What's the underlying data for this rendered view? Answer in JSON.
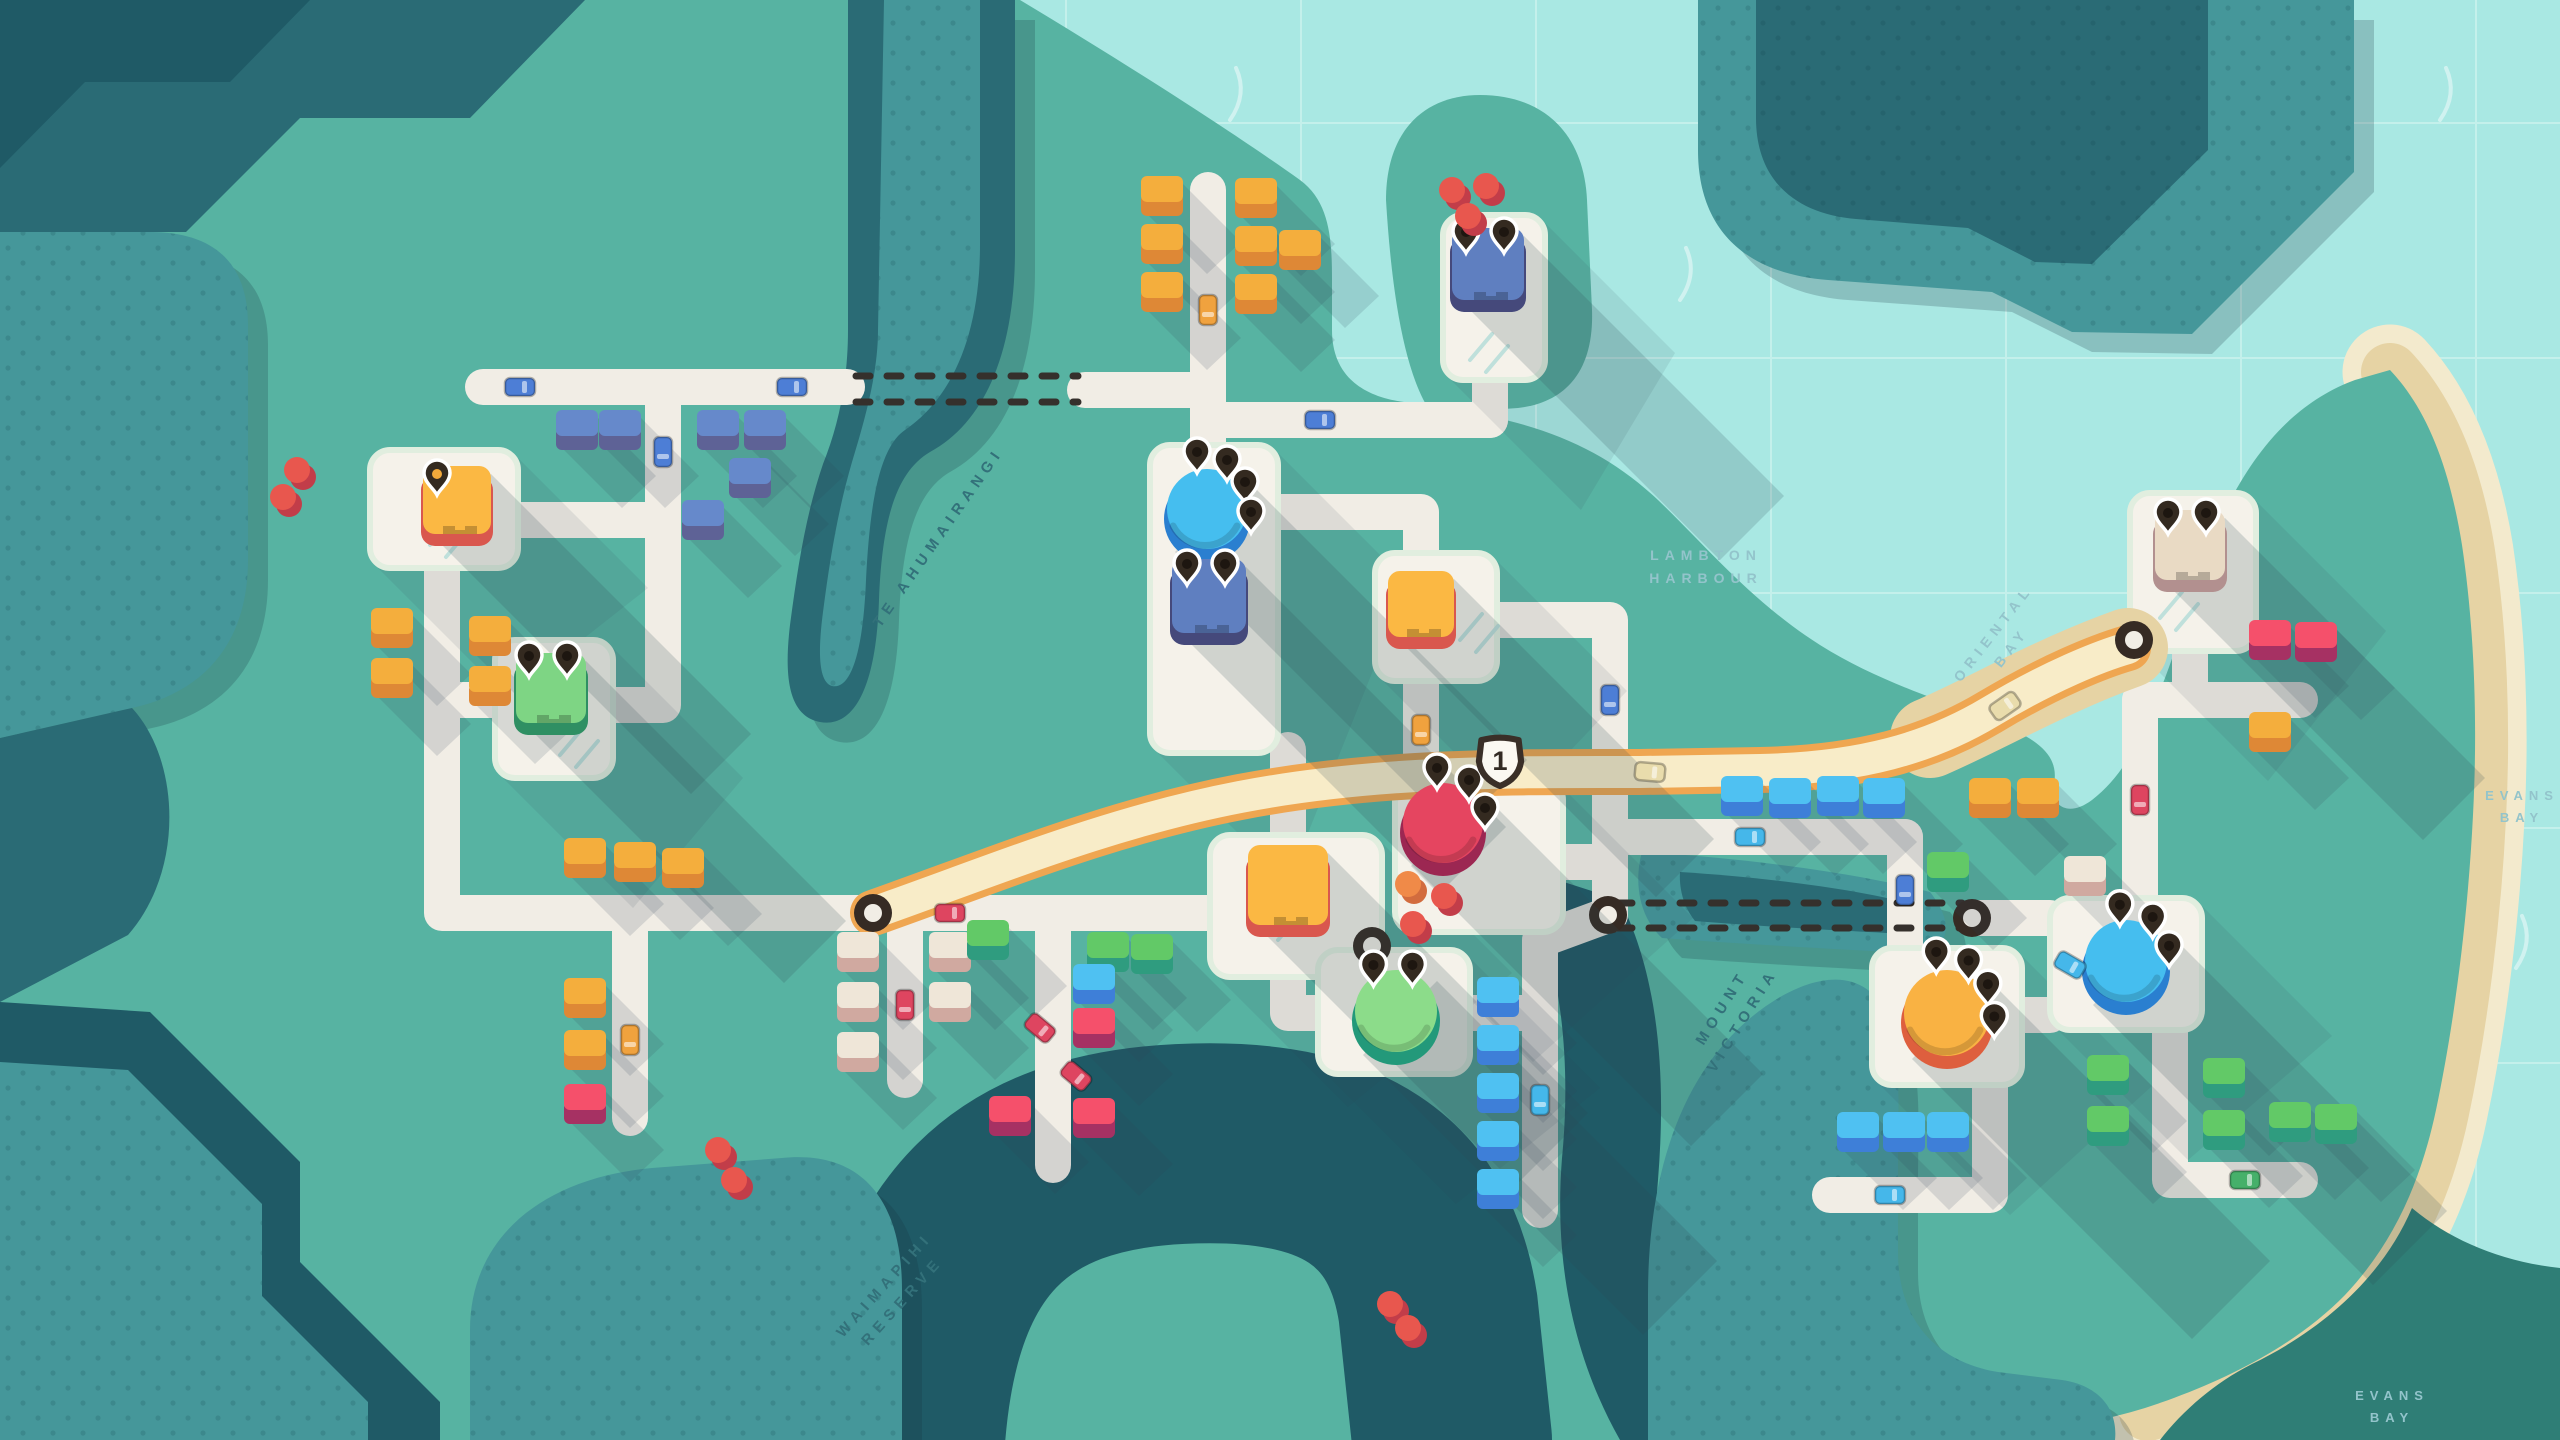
{
  "palette": {
    "water": "#A9E8E3",
    "grid": "#C4F0EB",
    "sparkle": "#FFFFFF",
    "landGreen": "#57B3A2",
    "hillMid": "#45979A",
    "hillDark": "#2A6B75",
    "hillDeep": "#1F5A66",
    "landDark": "#2F7E76",
    "sandLight": "#F3EACD",
    "sandDark": "#E6D3A4",
    "road": "#F1EDE5",
    "plaza": "#F5F2EA",
    "plazaEdge": "#E1EEDF",
    "hatch": "#BFE0DB",
    "motorwayEdge": "#EFA651",
    "motorwayFill": "#F8ECC8",
    "tunnelDash": "#35302C",
    "ringDark": "#362B24",
    "pinFill": "#342A20",
    "pinStroke": "#FFFFFF",
    "pinDot": "#1D1610",
    "badgeFill": "#FBF8F2",
    "badgeStroke": "#3A2F28",
    "badgeText": "#332A24",
    "labelWater": "#93C4CB",
    "labelLand": "#33717A",
    "shadow": "rgba(45,70,85,0.18)",
    "hillShadow": "rgba(22,52,64,0.22)"
  },
  "labels": [
    {
      "id": "lambton-harbour",
      "lines": [
        "LAMBTON",
        "HARBOUR"
      ],
      "x": 1706,
      "y": 560,
      "rot": 0,
      "on": "water",
      "fs": 14
    },
    {
      "id": "oriental-bay",
      "lines": [
        "ORIENTAL",
        "BAY"
      ],
      "x": 1997,
      "y": 636,
      "rot": -52,
      "on": "water",
      "fs": 14
    },
    {
      "id": "mount-victoria",
      "lines": [
        "MOUNT",
        "VICTORIA"
      ],
      "x": 1726,
      "y": 1010,
      "rot": -58,
      "on": "land",
      "fs": 15
    },
    {
      "id": "evans-bay-east",
      "lines": [
        "EVANS",
        "BAY"
      ],
      "x": 2522,
      "y": 800,
      "rot": 0,
      "on": "water",
      "fs": 13
    },
    {
      "id": "evans-bay-south",
      "lines": [
        "EVANS",
        "BAY"
      ],
      "x": 2392,
      "y": 1400,
      "rot": 0,
      "on": "water",
      "fs": 13
    },
    {
      "id": "waimapihi-reserve",
      "lines": [
        "WAIMAPIHI",
        "RESERVE"
      ],
      "x": 888,
      "y": 1288,
      "rot": -48,
      "on": "land",
      "fs": 15
    },
    {
      "id": "te-ahumairangi",
      "lines": [
        "TE AHUMAIRANGI"
      ],
      "x": 942,
      "y": 540,
      "rot": -55,
      "on": "land",
      "fs": 15
    }
  ],
  "motorway": {
    "badge_number": "1",
    "badge_x": 1500,
    "badge_y": 760,
    "path": "M873,913 C1000,868 1110,822 1240,797 C1380,770 1520,772 1640,772 L1760,770 C1860,768 1930,748 1990,712 C2050,676 2100,656 2128,648",
    "sand_underlay": "M1930,738 C1990,712 2050,676 2128,648"
  },
  "portals": [
    [
      873,
      913
    ],
    [
      1608,
      915
    ],
    [
      1972,
      918
    ],
    [
      2134,
      640
    ],
    [
      1372,
      946
    ]
  ],
  "tunnels": [
    {
      "x1": 856,
      "y1": 376,
      "x2": 1078,
      "y2": 376
    },
    {
      "x1": 856,
      "y1": 402,
      "x2": 1078,
      "y2": 402
    },
    {
      "x1": 1618,
      "y1": 903,
      "x2": 1962,
      "y2": 903
    },
    {
      "x1": 1618,
      "y1": 928,
      "x2": 1962,
      "y2": 928
    }
  ],
  "roads": [
    [
      [
        483,
        387
      ],
      [
        847,
        387
      ]
    ],
    [
      [
        663,
        387
      ],
      [
        663,
        520
      ],
      [
        515,
        520
      ]
    ],
    [
      [
        663,
        520
      ],
      [
        663,
        705
      ],
      [
        610,
        705
      ]
    ],
    [
      [
        442,
        565
      ],
      [
        442,
        913
      ],
      [
        1160,
        913
      ]
    ],
    [
      [
        495,
        700
      ],
      [
        442,
        700
      ]
    ],
    [
      [
        630,
        913
      ],
      [
        630,
        1118
      ]
    ],
    [
      [
        905,
        913
      ],
      [
        905,
        1080
      ]
    ],
    [
      [
        1053,
        913
      ],
      [
        1053,
        1165
      ]
    ],
    [
      [
        1160,
        913
      ],
      [
        1210,
        913
      ]
    ],
    [
      [
        1288,
        835
      ],
      [
        1288,
        750
      ]
    ],
    [
      [
        1288,
        975
      ],
      [
        1288,
        1013
      ],
      [
        1318,
        1013
      ]
    ],
    [
      [
        1208,
        190
      ],
      [
        1208,
        450
      ]
    ],
    [
      [
        1085,
        390
      ],
      [
        1208,
        390
      ]
    ],
    [
      [
        1208,
        420
      ],
      [
        1490,
        420
      ]
    ],
    [
      [
        1490,
        378
      ],
      [
        1490,
        420
      ]
    ],
    [
      [
        1275,
        512
      ],
      [
        1421,
        512
      ],
      [
        1421,
        555
      ]
    ],
    [
      [
        1421,
        680
      ],
      [
        1421,
        790
      ]
    ],
    [
      [
        1495,
        620
      ],
      [
        1610,
        620
      ],
      [
        1610,
        915
      ]
    ],
    [
      [
        1560,
        862
      ],
      [
        1610,
        862
      ]
    ],
    [
      [
        1468,
        1013
      ],
      [
        1540,
        1013
      ]
    ],
    [
      [
        1540,
        1210
      ],
      [
        1540,
        940
      ],
      [
        1608,
        915
      ]
    ],
    [
      [
        1610,
        837
      ],
      [
        1905,
        837
      ]
    ],
    [
      [
        1905,
        837
      ],
      [
        1905,
        950
      ]
    ],
    [
      [
        1972,
        918
      ],
      [
        2050,
        918
      ]
    ],
    [
      [
        2020,
        1015
      ],
      [
        2050,
        1015
      ]
    ],
    [
      [
        2190,
        651
      ],
      [
        2190,
        700
      ]
    ],
    [
      [
        2140,
        700
      ],
      [
        2300,
        700
      ]
    ],
    [
      [
        2140,
        700
      ],
      [
        2140,
        900
      ]
    ],
    [
      [
        1990,
        1085
      ],
      [
        1990,
        1195
      ],
      [
        1830,
        1195
      ]
    ],
    [
      [
        2170,
        1030
      ],
      [
        2170,
        1180
      ],
      [
        2300,
        1180
      ]
    ]
  ],
  "plazas": [
    [
      370,
      450,
      148,
      118
    ],
    [
      495,
      640,
      118,
      138
    ],
    [
      1443,
      215,
      102,
      165
    ],
    [
      1150,
      445,
      128,
      308
    ],
    [
      1375,
      553,
      122,
      128
    ],
    [
      1210,
      835,
      172,
      142
    ],
    [
      1395,
      780,
      168,
      152
    ],
    [
      1318,
      950,
      152,
      124
    ],
    [
      1872,
      948,
      150,
      137
    ],
    [
      2050,
      898,
      152,
      132
    ],
    [
      2130,
      493,
      126,
      158
    ]
  ],
  "hatches": [
    [
      430,
      545
    ],
    [
      560,
      755
    ],
    [
      1460,
      640
    ],
    [
      1262,
      928
    ],
    [
      2160,
      618
    ],
    [
      1470,
      360
    ]
  ],
  "destinations": [
    {
      "kind": "circle",
      "color": "blue",
      "x": 1207,
      "y": 512,
      "r": 40,
      "pins": 4
    },
    {
      "kind": "circle",
      "color": "red",
      "x": 1443,
      "y": 826,
      "r": 40,
      "pins": 3
    },
    {
      "kind": "circle",
      "color": "green",
      "x": 1396,
      "y": 1014,
      "r": 41,
      "pins": 2
    },
    {
      "kind": "circle",
      "color": "orange",
      "x": 1947,
      "y": 1016,
      "r": 43,
      "pins": 4
    },
    {
      "kind": "circle",
      "color": "blue",
      "x": 2126,
      "y": 964,
      "r": 41,
      "pins": 3
    },
    {
      "kind": "square",
      "color": "orange",
      "x": 457,
      "y": 500,
      "s": 68,
      "pins": 1,
      "pin_dot": "#F2A93B"
    },
    {
      "kind": "square",
      "color": "green",
      "x": 551,
      "y": 688,
      "s": 70,
      "pins": 2
    },
    {
      "kind": "square",
      "color": "blue",
      "x": 1488,
      "y": 264,
      "s": 72,
      "pins": 2
    },
    {
      "kind": "square",
      "color": "blue",
      "x": 1209,
      "y": 596,
      "s": 74,
      "pins": 2
    },
    {
      "kind": "square",
      "color": "orange",
      "x": 1421,
      "y": 604,
      "s": 66,
      "pins": 0
    },
    {
      "kind": "square",
      "color": "orange",
      "x": 1288,
      "y": 885,
      "s": 80,
      "pins": 0
    },
    {
      "kind": "square",
      "color": "beige",
      "x": 2190,
      "y": 545,
      "s": 70,
      "pins": 2
    }
  ],
  "circle_colors": {
    "blue": [
      "#45BEEF",
      "#2A7FD0"
    ],
    "red": [
      "#E54560",
      "#9C2752"
    ],
    "green": [
      "#8CDC8A",
      "#23997A"
    ],
    "orange": [
      "#F9B243",
      "#DE5F3E"
    ]
  },
  "square_colors": {
    "blue": [
      "#5F7FC0",
      "#45497B"
    ],
    "green": [
      "#7ED584",
      "#2F8F63"
    ],
    "orange": [
      "#FBB843",
      "#D9574E"
    ],
    "beige": [
      "#E9DAC4",
      "#B2908F"
    ]
  },
  "house_colors": {
    "blue": [
      "#6689CB",
      "#5E6296"
    ],
    "cyan": [
      "#4FC1F2",
      "#3E7FD8"
    ],
    "orange": [
      "#F4AE3D",
      "#DE8836"
    ],
    "green": [
      "#62C967",
      "#2F9C7F"
    ],
    "red": [
      "#F5506B",
      "#A63163"
    ],
    "beige": [
      "#EFE6D8",
      "#D0A9A0"
    ]
  },
  "houses": [
    [
      "blue",
      577,
      430
    ],
    [
      "blue",
      620,
      430
    ],
    [
      "blue",
      718,
      430
    ],
    [
      "blue",
      765,
      430
    ],
    [
      "blue",
      750,
      478
    ],
    [
      "blue",
      703,
      520
    ],
    [
      "orange",
      392,
      628
    ],
    [
      "orange",
      392,
      678
    ],
    [
      "orange",
      490,
      636
    ],
    [
      "orange",
      490,
      686
    ],
    [
      "orange",
      1162,
      196
    ],
    [
      "orange",
      1256,
      198
    ],
    [
      "orange",
      1162,
      244
    ],
    [
      "orange",
      1256,
      246
    ],
    [
      "orange",
      1300,
      250
    ],
    [
      "orange",
      1162,
      292
    ],
    [
      "orange",
      1256,
      294
    ],
    [
      "orange",
      585,
      858
    ],
    [
      "orange",
      635,
      862
    ],
    [
      "orange",
      683,
      868
    ],
    [
      "orange",
      585,
      998
    ],
    [
      "orange",
      585,
      1050
    ],
    [
      "red",
      585,
      1104
    ],
    [
      "beige",
      858,
      952
    ],
    [
      "beige",
      858,
      1002
    ],
    [
      "beige",
      858,
      1052
    ],
    [
      "beige",
      950,
      952
    ],
    [
      "beige",
      950,
      1002
    ],
    [
      "green",
      988,
      940
    ],
    [
      "green",
      1108,
      952
    ],
    [
      "green",
      1152,
      954
    ],
    [
      "cyan",
      1094,
      984
    ],
    [
      "red",
      1094,
      1028
    ],
    [
      "red",
      1010,
      1116
    ],
    [
      "red",
      1094,
      1118
    ],
    [
      "cyan",
      1498,
      997
    ],
    [
      "cyan",
      1498,
      1045
    ],
    [
      "cyan",
      1498,
      1093
    ],
    [
      "cyan",
      1498,
      1141
    ],
    [
      "cyan",
      1498,
      1189
    ],
    [
      "cyan",
      1742,
      796
    ],
    [
      "cyan",
      1790,
      798
    ],
    [
      "cyan",
      1838,
      796
    ],
    [
      "cyan",
      1884,
      798
    ],
    [
      "green",
      1948,
      872
    ],
    [
      "orange",
      1990,
      798
    ],
    [
      "orange",
      2038,
      798
    ],
    [
      "beige",
      2085,
      876
    ],
    [
      "red",
      2270,
      640
    ],
    [
      "red",
      2316,
      642
    ],
    [
      "orange",
      2270,
      732
    ],
    [
      "green",
      2108,
      1075
    ],
    [
      "green",
      2224,
      1078
    ],
    [
      "green",
      2108,
      1126
    ],
    [
      "green",
      2224,
      1130
    ],
    [
      "green",
      2290,
      1122
    ],
    [
      "green",
      2336,
      1124
    ],
    [
      "cyan",
      1858,
      1132
    ],
    [
      "cyan",
      1904,
      1132
    ],
    [
      "cyan",
      1948,
      1132
    ]
  ],
  "tree_colors": {
    "red": [
      "#E8574E",
      "#C23D49"
    ],
    "orange": [
      "#F08A48",
      "#D26C3E"
    ]
  },
  "trees": [
    [
      "red",
      297,
      470
    ],
    [
      "red",
      283,
      497
    ],
    [
      "red",
      1452,
      190
    ],
    [
      "red",
      1486,
      186
    ],
    [
      "red",
      1468,
      216
    ],
    [
      "orange",
      1408,
      884
    ],
    [
      "red",
      1444,
      896
    ],
    [
      "red",
      1413,
      924
    ],
    [
      "red",
      718,
      1150
    ],
    [
      "red",
      734,
      1180
    ],
    [
      "red",
      1390,
      1304
    ],
    [
      "red",
      1408,
      1328
    ]
  ],
  "car_colors": {
    "blue": "#4D7ED6",
    "red": "#DE4560",
    "orange": "#F0A23E",
    "green": "#46B06A",
    "cyan": "#45B7EA",
    "sand": "#E9DCAC"
  },
  "cars": [
    [
      "blue",
      520,
      387,
      0
    ],
    [
      "blue",
      792,
      387,
      0
    ],
    [
      "blue",
      663,
      452,
      90
    ],
    [
      "red",
      950,
      913,
      0
    ],
    [
      "red",
      905,
      1005,
      90
    ],
    [
      "orange",
      630,
      1040,
      90
    ],
    [
      "orange",
      1208,
      310,
      90
    ],
    [
      "blue",
      1320,
      420,
      0
    ],
    [
      "orange",
      1421,
      730,
      90
    ],
    [
      "blue",
      1610,
      700,
      90
    ],
    [
      "cyan",
      1750,
      837,
      0
    ],
    [
      "blue",
      1905,
      890,
      90
    ],
    [
      "red",
      2140,
      800,
      90
    ],
    [
      "cyan",
      1540,
      1100,
      90
    ],
    [
      "cyan",
      1890,
      1195,
      0
    ],
    [
      "green",
      2245,
      1180,
      0
    ],
    [
      "red",
      1040,
      1028,
      40
    ],
    [
      "red",
      1076,
      1076,
      40
    ],
    [
      "cyan",
      2070,
      965,
      30
    ],
    [
      "sand",
      1650,
      772,
      5
    ],
    [
      "sand",
      2005,
      706,
      -35
    ]
  ],
  "sparkles": [
    [
      1230,
      120
    ],
    [
      2440,
      120
    ],
    [
      2462,
      1050
    ],
    [
      2516,
      968
    ],
    [
      1680,
      300
    ]
  ]
}
